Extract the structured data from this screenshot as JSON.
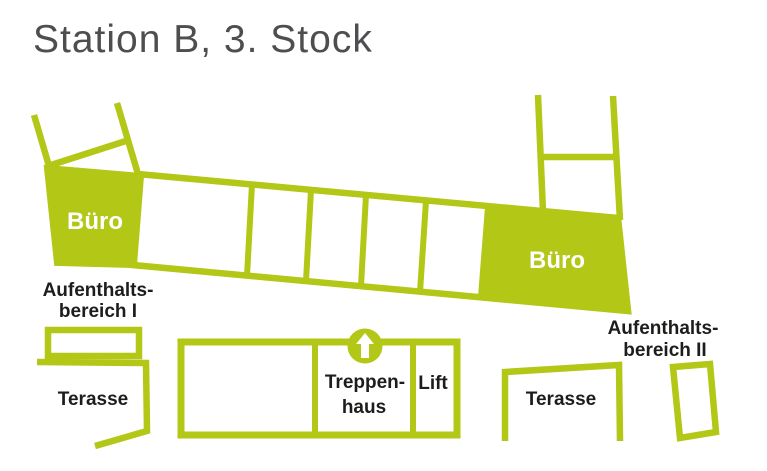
{
  "title": "Station B, 3. Stock",
  "colors": {
    "green": "#b2c716",
    "title_gray": "#4e4e50",
    "label_black": "#1d1d1b",
    "room_white": "#ffffff"
  },
  "floorplan": {
    "offices": {
      "left_label": "Büro",
      "right_label": "Büro"
    },
    "lounge_area_1": {
      "line1": "Aufenthalts-",
      "line2": "bereich I"
    },
    "lounge_area_2": {
      "line1": "Aufenthalts-",
      "line2": "bereich II"
    },
    "terrace_left": {
      "label": "Terasse"
    },
    "terrace_right": {
      "label": "Terasse"
    },
    "stairwell": {
      "line1": "Treppen-",
      "line2": "haus",
      "icon": "up-arrow"
    },
    "lift": {
      "label": "Lift"
    }
  }
}
